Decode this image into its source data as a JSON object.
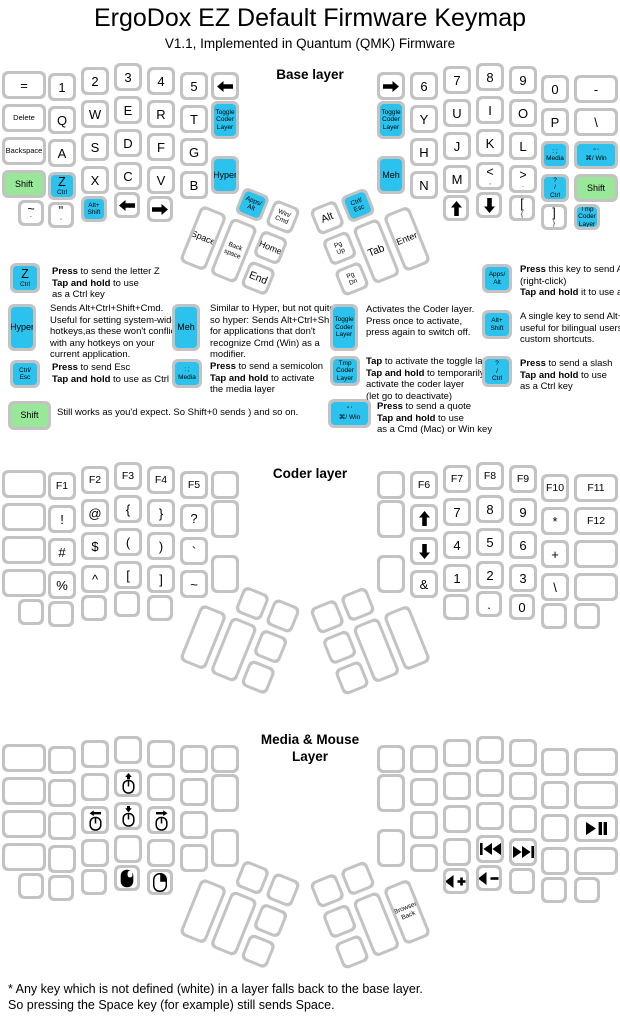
{
  "title": "ErgoDox EZ Default Firmware Keymap",
  "subtitle": "V1.1, Implemented in Quantum (QMK) Firmware",
  "footer": "* Any key which is not defined (white) in a layer falls back to the base layer.\nSo pressing the Space key (for example) still sends Space.",
  "colors": {
    "blue": "#2bc2ee",
    "green": "#99e899",
    "key_border": "#c3c3c3"
  },
  "layers": [
    {
      "name": "base",
      "title": "Base layer",
      "left": {
        "rows": [
          [
            "=",
            "1",
            "2",
            "3",
            "4",
            "5",
            {
              "icon": "arrow-left"
            }
          ],
          [
            "Delete",
            "Q",
            "W",
            "E",
            "R",
            "T"
          ],
          [
            "Backspace",
            "A",
            "S",
            "D",
            "F",
            "G"
          ],
          [
            {
              "t": "Shift",
              "c": "green"
            },
            {
              "t": "Z",
              "s": "Ctrl",
              "c": "blue"
            },
            "X",
            "C",
            "V",
            "B"
          ],
          [
            {
              "t": "~",
              "s": "`"
            },
            {
              "t": "\"",
              "s": "'"
            },
            {
              "lines": [
                "Alt+",
                "Shift"
              ],
              "c": "blue"
            },
            {
              "icon": "arrow-left"
            },
            {
              "icon": "arrow-right"
            }
          ]
        ],
        "inner": [
          {
            "lines": [
              "Toggle",
              "Coder",
              "Layer"
            ],
            "c": "blue"
          },
          {
            "t": "Hyper",
            "c": "blue"
          }
        ],
        "thumb": [
          {
            "lines": [
              "Apps/",
              "Alt"
            ],
            "c": "blue"
          },
          {
            "lines": [
              "Win/",
              "Cmd"
            ]
          },
          "Space",
          {
            "lines": [
              "Back",
              "space"
            ]
          },
          "Home",
          "End"
        ]
      },
      "right": {
        "rows": [
          [
            {
              "icon": "arrow-right"
            },
            "6",
            "7",
            "8",
            "9",
            "0",
            "-"
          ],
          [
            "Y",
            "U",
            "I",
            "O",
            "P",
            "\\"
          ],
          [
            "H",
            "J",
            "K",
            "L",
            {
              "lines": [
                ": ;",
                "Media"
              ],
              "c": "blue"
            },
            {
              "lines": [
                "\" '",
                "⌘/ Win"
              ],
              "c": "blue"
            }
          ],
          [
            "N",
            "M",
            {
              "t": "<",
              "s": ","
            },
            {
              "t": ">",
              "s": "."
            },
            {
              "lines": [
                "?",
                "/",
                "Ctrl"
              ],
              "c": "blue"
            },
            {
              "t": "Shift",
              "c": "green"
            }
          ],
          [
            {
              "icon": "arrow-up"
            },
            {
              "icon": "arrow-down"
            },
            {
              "t": "[",
              "s": "{"
            },
            {
              "t": "]",
              "s": "}"
            },
            {
              "lines": [
                "Tmp",
                "Coder",
                "Layer"
              ],
              "c": "blue"
            }
          ]
        ],
        "inner": [
          {
            "lines": [
              "Toggle",
              "Coder",
              "Layer"
            ],
            "c": "blue"
          },
          {
            "t": "Meh",
            "c": "blue"
          }
        ],
        "thumb": [
          "Alt",
          {
            "lines": [
              "Ctrl/",
              "Esc"
            ],
            "c": "blue"
          },
          {
            "lines": [
              "Pg",
              "Up"
            ]
          },
          {
            "lines": [
              "Pg",
              "Dn"
            ]
          },
          "Tab",
          "Enter"
        ]
      }
    },
    {
      "name": "coder",
      "title": "Coder layer",
      "left": {
        "rows": [
          [
            null,
            "F1",
            "F2",
            "F3",
            "F4",
            "F5",
            null
          ],
          [
            null,
            "!",
            "@",
            "{",
            "}",
            "?"
          ],
          [
            null,
            "#",
            "$",
            "(",
            ")",
            "`"
          ],
          [
            null,
            "%",
            "^",
            "[",
            "]",
            "~"
          ],
          [
            null,
            null,
            null,
            null,
            null
          ]
        ],
        "inner": [
          null,
          null
        ],
        "thumb": [
          null,
          null,
          null,
          null,
          null,
          null
        ]
      },
      "right": {
        "rows": [
          [
            null,
            "F6",
            "F7",
            "F8",
            "F9",
            "F10",
            "F11"
          ],
          [
            {
              "icon": "arrow-up"
            },
            "7",
            "8",
            "9",
            "*",
            "F12"
          ],
          [
            {
              "icon": "arrow-down"
            },
            "4",
            "5",
            "6",
            "+",
            null
          ],
          [
            "&",
            "1",
            "2",
            "3",
            "\\",
            null
          ],
          [
            null,
            ".",
            "0",
            null,
            null
          ]
        ],
        "inner": [
          null,
          null
        ],
        "thumb": [
          null,
          null,
          null,
          null,
          null,
          null
        ]
      }
    },
    {
      "name": "media",
      "title": "Media & Mouse Layer",
      "left": {
        "rows": [
          [
            null,
            null,
            null,
            null,
            null,
            null,
            null
          ],
          [
            null,
            null,
            null,
            {
              "icon": "mouse-move-up"
            },
            null,
            null
          ],
          [
            null,
            null,
            {
              "icon": "mouse-move-left"
            },
            {
              "icon": "mouse-move-down"
            },
            {
              "icon": "mouse-move-right"
            },
            null
          ],
          [
            null,
            null,
            null,
            null,
            null,
            null
          ],
          [
            null,
            null,
            null,
            {
              "icon": "mouse-left-click"
            },
            {
              "icon": "mouse-right-click"
            }
          ]
        ],
        "inner": [
          null,
          null
        ],
        "thumb": [
          null,
          null,
          null,
          null,
          null,
          null
        ]
      },
      "right": {
        "rows": [
          [
            null,
            null,
            null,
            null,
            null,
            null,
            null
          ],
          [
            null,
            null,
            null,
            null,
            null,
            null
          ],
          [
            null,
            null,
            null,
            null,
            null,
            {
              "icon": "play-pause"
            }
          ],
          [
            null,
            null,
            {
              "icon": "prev-track"
            },
            {
              "icon": "next-track"
            },
            null,
            null
          ],
          [
            {
              "icon": "volume-up"
            },
            {
              "icon": "volume-down"
            },
            null,
            null,
            null
          ]
        ],
        "inner": [
          null,
          null
        ],
        "thumb": [
          null,
          null,
          null,
          null,
          null,
          {
            "lines": [
              "Browser",
              "Back"
            ]
          }
        ]
      }
    }
  ],
  "legend": [
    {
      "key": {
        "t": "Z",
        "s": "Ctrl",
        "c": "blue"
      },
      "text": "**Press** to send the letter Z\n**Tap and hold** to use\nas a Ctrl key"
    },
    {
      "key": {
        "t": "Hyper",
        "c": "blue"
      },
      "text": "Sends Alt+Ctrl+Shift+Cmd.\nUseful for setting system-wide\nhotkeys,as these won't conflict\nwith any hotkeys on your\ncurrent application."
    },
    {
      "key": {
        "lines": [
          "Ctrl/",
          "Esc"
        ],
        "c": "blue"
      },
      "text": "**Press** to send Esc\n**Tap and hold** to use as Ctrl"
    },
    {
      "key": {
        "t": "Shift",
        "c": "green"
      },
      "text": "Still works as you'd expect. So Shift+0 sends ) and so on."
    },
    {
      "key": {
        "t": "Meh",
        "c": "blue"
      },
      "text": "Similar to Hyper, but not quite\nso hyper: Sends Alt+Ctrl+Shift,\nfor applications that don't\nrecognize Cmd (Win) as a\nmodifier."
    },
    {
      "key": {
        "lines": [
          ": ;",
          "Media"
        ],
        "c": "blue"
      },
      "text": "**Press** to send a semicolon\n**Tap and hold** to activate\nthe media layer"
    },
    {
      "key": {
        "lines": [
          "Toggle",
          "Coder",
          "Layer"
        ],
        "c": "blue"
      },
      "text": "Activates the Coder layer.\nPress once to activate,\npress again to switch off."
    },
    {
      "key": {
        "lines": [
          "Tmp",
          "Coder",
          "Layer"
        ],
        "c": "blue"
      },
      "text": "**Tap** to activate the toggle layer.\n**Tap and hold** to temporarily\nactivate the coder layer\n(let go to deactivate)"
    },
    {
      "key": {
        "lines": [
          "\" '",
          "⌘/ Win"
        ],
        "c": "blue"
      },
      "text": "**Press** to send a quote\n**Tap and hold** to use\nas a Cmd (Mac) or Win key"
    },
    {
      "key": {
        "lines": [
          "Apps/",
          "Alt"
        ],
        "c": "blue"
      },
      "text": "**Press** this key to send Apps\n(right-click)\n**Tap and hold** it to use as Alt"
    },
    {
      "key": {
        "lines": [
          "Alt+",
          "Shift"
        ],
        "c": "blue"
      },
      "text": "A single key to send Alt+Shift,\nuseful for bilingual users and\ncustom shortcuts."
    },
    {
      "key": {
        "lines": [
          "?",
          "/",
          "Ctrl"
        ],
        "c": "blue"
      },
      "text": "**Press** to send a slash\n**Tap and hold** to use\nas a Ctrl key"
    }
  ]
}
